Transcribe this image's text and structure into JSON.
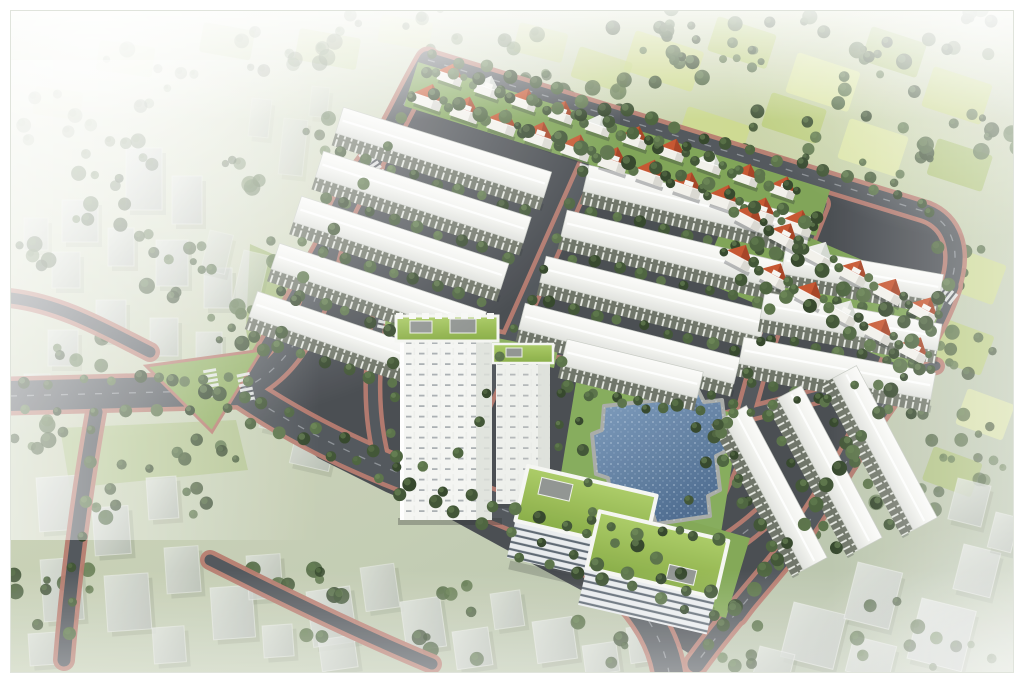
{
  "image": {
    "kind": "aerial-architectural-rendering",
    "subject": "residential-estate-masterplan-birdseye",
    "width": 1024,
    "height": 683,
    "frame_color": "#ffffff"
  },
  "palette": {
    "mist": "#f5f7f3",
    "landLight": "#e2e7d6",
    "land": "#c6cfb4",
    "landDark": "#b7c2aa",
    "asphalt": "#44484d",
    "roadFill": "#4e5358",
    "roadLine": "#b9c0c4",
    "sidewalk": "#b5786b",
    "sidewalkLight": "#c69084",
    "roofWhite": "#f6f7f4",
    "roofShade": "#e0e2dd",
    "facade": "#6b7164",
    "facadeTick": "#eef0ea",
    "villaRed": "#c5522b",
    "villaRedDark": "#9e3c1f",
    "villaWhiteRoof": "#ebede8",
    "villaWall": "#f2f1eb",
    "towerWhite": "#f4f5f2",
    "towerShade": "#dcdfd9",
    "greenRoof": "#96bb4f",
    "greenRoofLight": "#aacb63",
    "poolBlue": "#5d81a8",
    "poolDeep": "#49688c",
    "poolStone": "#a7aaa6",
    "lawn": "#7ca253",
    "lawnBright": "#95b863",
    "ghost": "#c6cbc4",
    "ghostLight": "#dfe3dd",
    "ghostDark": "#b2b8b1"
  },
  "scene": {
    "treeColors": [
      "#3c5130",
      "#48603a",
      "#577045",
      "#2f4226"
    ],
    "treeHighs": [
      "#63804d",
      "#577045",
      "#6f8c58"
    ],
    "fieldColors": [
      "#cdd98b",
      "#b9cc74",
      "#dde7a4",
      "#a6bd68",
      "#c4d480"
    ],
    "site": "426,56 932,210 958,258 944,304 898,372 858,468 800,554 742,618 690,654 618,610 540,568 452,520 386,492 318,458 252,398 286,326 330,244 368,170",
    "contextLawns": [
      {
        "p": "250,244 372,298 384,456 262,420 246,330",
        "f": "#9db66f",
        "o": 0.9
      },
      {
        "p": "60,428 236,420 248,470 70,488",
        "f": "#a4bc74",
        "o": 0.55
      }
    ],
    "rows": {
      "items": [
        [
          342,
          112,
          218
        ],
        [
          322,
          156,
          218
        ],
        [
          300,
          201,
          218
        ],
        [
          278,
          248,
          218
        ],
        [
          256,
          296,
          215
        ],
        [
          588,
          170,
          230
        ],
        [
          566,
          215,
          230
        ],
        [
          545,
          261,
          228
        ],
        [
          524,
          308,
          222
        ],
        [
          566,
          344,
          140
        ],
        [
          785,
          252,
          160
        ],
        [
          764,
          297,
          180
        ],
        [
          743,
          342,
          195
        ]
      ],
      "steep": [
        [
          742,
          408,
          172,
          62
        ],
        [
          797,
          388,
          172,
          62
        ],
        [
          852,
          368,
          172,
          62
        ]
      ]
    },
    "villas": {
      "lines": [
        {
          "from": [
            430,
            92
          ],
          "step": [
            37,
            12.6
          ],
          "rot": 19,
          "size": 30,
          "roofs": "RRRRRRRRRRR"
        },
        {
          "from": [
            452,
            70
          ],
          "step": [
            37,
            12.6
          ],
          "rot": 19,
          "size": 26,
          "roofs": "RWRRWRRWRR"
        },
        {
          "from": [
            752,
            212
          ],
          "step": [
            35,
            18.5
          ],
          "rot": 28,
          "size": 29,
          "roofs": "RRWRRR"
        },
        {
          "from": [
            742,
            252
          ],
          "step": [
            35,
            18.5
          ],
          "rot": 28,
          "size": 29,
          "roofs": "RRRWRR"
        }
      ]
    },
    "roads": {
      "major": [
        {
          "d": "M 10 396 L 240 390",
          "w": 30
        },
        {
          "d": "M 240 390 C 292 368 312 318 324 266 C 332 228 346 194 370 164",
          "w": 22
        },
        {
          "d": "M 370 164 C 392 132 408 94 428 60",
          "w": 18
        },
        {
          "d": "M 428 60 L 926 212",
          "w": 15
        },
        {
          "d": "M 926 212 C 952 222 962 250 950 286",
          "w": 15
        },
        {
          "d": "M 950 286 C 932 338 902 378 874 418 C 846 460 814 520 782 558 C 756 590 722 628 696 664",
          "w": 17
        },
        {
          "d": "M 240 390 C 320 444 400 476 470 498 C 540 520 582 548 620 586 C 648 614 666 644 670 680",
          "w": 28
        },
        {
          "d": "M 618 584 C 678 576 724 552 762 518",
          "w": 16
        }
      ],
      "minor": [
        {
          "d": "M 366 168 C 322 248 284 322 242 388",
          "w": 13
        },
        {
          "d": "M 592 156 L 448 480",
          "w": 13
        },
        {
          "d": "M 820 204 C 790 280 768 330 752 390 C 740 434 722 500 676 556",
          "w": 13
        },
        {
          "d": "M 902 330 C 884 378 858 440 826 492 C 798 538 766 578 738 616",
          "w": 12
        },
        {
          "d": "M 380 316 C 370 368 370 420 384 468",
          "w": 10
        },
        {
          "d": "M 382 314 L 566 352",
          "w": 9
        },
        {
          "d": "M 692 428 L 936 366",
          "w": 9
        },
        {
          "d": "M 96 412 C 84 480 72 560 64 660",
          "w": 13
        },
        {
          "d": "M 10 298 C 62 304 106 330 150 352",
          "w": 11
        },
        {
          "d": "M 210 560 C 290 600 360 634 432 664",
          "w": 11
        }
      ]
    },
    "crosswalks": [
      [
        246,
        388,
        78
      ],
      [
        372,
        164,
        56
      ],
      [
        588,
        160,
        109
      ],
      [
        816,
        212,
        109
      ],
      [
        944,
        292,
        38
      ],
      [
        434,
        484,
        15
      ],
      [
        618,
        580,
        22
      ],
      [
        386,
        316,
        102
      ],
      [
        212,
        384,
        80
      ]
    ],
    "median": {
      "p": "146,366 262,350 212,432",
      "f": "#8fae60"
    },
    "siteLawns": [
      {
        "p": "418,62 830,190 816,236 404,106",
        "f": "#7ca253",
        "o": 1
      },
      {
        "p": "732,204 946,296 916,372 700,280",
        "f": "#7ca253",
        "o": 1
      },
      {
        "p": "576,382 740,414 718,552 554,516",
        "f": "#83aa58",
        "o": 1
      },
      {
        "p": "516,472 750,538 726,618 648,596 600,556 540,510",
        "f": "#7fa652",
        "o": 1
      },
      {
        "p": "386,316 558,350 554,368 384,334",
        "f": "#8aae5c",
        "o": 1
      }
    ],
    "pool": {
      "points": "604,406 660,400 664,392 698,390 704,402 722,400 728,450 716,456 720,490 708,496 710,516 656,524 652,512 614,516 608,478 596,474 592,434 602,430"
    },
    "fields": [
      [
        636,
        30,
        72,
        42,
        18,
        0.9
      ],
      [
        718,
        16,
        62,
        36,
        18,
        0.85
      ],
      [
        798,
        52,
        66,
        42,
        18,
        0.9
      ],
      [
        872,
        26,
        58,
        36,
        18,
        0.85
      ],
      [
        934,
        66,
        62,
        42,
        18,
        0.9
      ],
      [
        688,
        106,
        66,
        40,
        18,
        0.85
      ],
      [
        772,
        92,
        58,
        36,
        18,
        0.8
      ],
      [
        850,
        118,
        62,
        42,
        18,
        0.85
      ],
      [
        938,
        138,
        58,
        38,
        18,
        0.85
      ],
      [
        902,
        208,
        56,
        38,
        20,
        0.8
      ],
      [
        958,
        248,
        52,
        42,
        20,
        0.8
      ],
      [
        944,
        318,
        54,
        42,
        20,
        0.8
      ],
      [
        968,
        388,
        50,
        38,
        20,
        0.75
      ],
      [
        934,
        446,
        52,
        36,
        20,
        0.7
      ],
      [
        580,
        46,
        56,
        32,
        18,
        0.7
      ],
      [
        520,
        22,
        50,
        30,
        14,
        0.5
      ],
      [
        300,
        28,
        62,
        32,
        10,
        0.4
      ],
      [
        382,
        14,
        52,
        28,
        10,
        0.35
      ],
      [
        204,
        22,
        52,
        30,
        10,
        0.3
      ],
      [
        100,
        40,
        56,
        30,
        8,
        0.25
      ],
      [
        36,
        86,
        48,
        28,
        8,
        0.2
      ]
    ],
    "hedges": [
      [
        682,
        58,
        58,
        13,
        0.95
      ],
      [
        780,
        38,
        52,
        11,
        0.9
      ],
      [
        884,
        80,
        62,
        13,
        0.95
      ],
      [
        962,
        38,
        46,
        9,
        0.9
      ],
      [
        760,
        140,
        56,
        11,
        0.9
      ],
      [
        900,
        162,
        52,
        10,
        0.9
      ],
      [
        982,
        142,
        42,
        8,
        0.85
      ],
      [
        940,
        262,
        46,
        9,
        0.85
      ],
      [
        976,
        352,
        42,
        8,
        0.8
      ],
      [
        956,
        432,
        42,
        8,
        0.75
      ],
      [
        638,
        22,
        42,
        8,
        0.85
      ],
      [
        588,
        92,
        44,
        9,
        0.8
      ],
      [
        524,
        60,
        40,
        7,
        0.6
      ],
      [
        440,
        30,
        44,
        7,
        0.5
      ],
      [
        348,
        44,
        52,
        8,
        0.45
      ],
      [
        252,
        56,
        46,
        7,
        0.4
      ],
      [
        150,
        76,
        52,
        8,
        0.35
      ],
      [
        60,
        120,
        44,
        7,
        0.3
      ],
      [
        906,
        506,
        40,
        7,
        0.6
      ],
      [
        986,
        472,
        30,
        5,
        0.6
      ]
    ],
    "scatters": [
      [
        92,
        198,
        48,
        8,
        0.8
      ],
      [
        198,
        296,
        56,
        9,
        0.85
      ],
      [
        322,
        382,
        52,
        9,
        0.9
      ],
      [
        252,
        328,
        40,
        7,
        0.9
      ],
      [
        148,
        498,
        64,
        10,
        0.85
      ],
      [
        58,
        598,
        56,
        9,
        0.8
      ],
      [
        282,
        608,
        64,
        10,
        0.85
      ],
      [
        466,
        622,
        56,
        8,
        0.8
      ],
      [
        610,
        636,
        44,
        6,
        0.8
      ],
      [
        900,
        632,
        52,
        7,
        0.8
      ],
      [
        822,
        524,
        36,
        5,
        0.8
      ],
      [
        40,
        440,
        40,
        7,
        0.8
      ],
      [
        210,
        442,
        36,
        6,
        0.85
      ],
      [
        360,
        300,
        36,
        6,
        0.85
      ],
      [
        300,
        250,
        34,
        6,
        0.8
      ],
      [
        86,
        348,
        38,
        6,
        0.8
      ],
      [
        26,
        260,
        36,
        6,
        0.7
      ],
      [
        170,
        240,
        36,
        6,
        0.8
      ],
      [
        120,
        160,
        40,
        7,
        0.6
      ],
      [
        230,
        170,
        36,
        6,
        0.6
      ],
      [
        330,
        140,
        34,
        6,
        0.6
      ],
      [
        740,
        662,
        40,
        6,
        0.75
      ],
      [
        962,
        662,
        36,
        5,
        0.7
      ]
    ],
    "treelines": [
      [
        436,
        54,
        920,
        202,
        21,
        6
      ],
      [
        432,
        94,
        806,
        220,
        16,
        6.5
      ],
      [
        452,
        72,
        788,
        184,
        14,
        5.5
      ],
      [
        754,
        240,
        928,
        330,
        9,
        6.5
      ],
      [
        742,
        276,
        916,
        366,
        9,
        6
      ],
      [
        940,
        300,
        864,
        434,
        7,
        6.5
      ],
      [
        852,
        452,
        778,
        558,
        7,
        6.5
      ],
      [
        766,
        572,
        706,
        646,
        5,
        6.5
      ],
      [
        586,
        174,
        462,
        452,
        10,
        5
      ],
      [
        814,
        218,
        678,
        528,
        11,
        5.5
      ],
      [
        360,
        180,
        252,
        378,
        9,
        6
      ],
      [
        386,
        146,
        426,
        70,
        4,
        5.5
      ],
      [
        264,
        404,
        424,
        470,
        7,
        6
      ],
      [
        444,
        488,
        636,
        548,
        9,
        6
      ],
      [
        658,
        558,
        760,
        628,
        5,
        6.5
      ],
      [
        252,
        420,
        432,
        498,
        8,
        6
      ],
      [
        452,
        514,
        688,
        592,
        9,
        6
      ],
      [
        20,
        382,
        232,
        378,
        8,
        5.5
      ],
      [
        22,
        412,
        228,
        408,
        7,
        5.5
      ],
      [
        160,
        378,
        244,
        398,
        5,
        6.5
      ],
      [
        90,
        432,
        68,
        636,
        7,
        5.5
      ],
      [
        390,
        330,
        396,
        498,
        6,
        5.5
      ],
      [
        560,
        362,
        560,
        450,
        4,
        5
      ],
      [
        592,
        400,
        732,
        414,
        6,
        5.5
      ],
      [
        588,
        524,
        718,
        542,
        6,
        5.5
      ],
      [
        580,
        424,
        590,
        512,
        4,
        5
      ],
      [
        730,
        426,
        740,
        506,
        4,
        5
      ],
      [
        522,
        556,
        716,
        614,
        8,
        5.5
      ],
      [
        926,
        214,
        948,
        286,
        3,
        5.5
      ],
      [
        694,
        428,
        934,
        368,
        10,
        4.5
      ]
    ],
    "ghosts": [
      [
        126,
        148,
        36,
        62,
        0,
        0.8
      ],
      [
        172,
        176,
        30,
        48,
        0,
        0.8
      ],
      [
        62,
        200,
        36,
        42,
        0,
        0.75
      ],
      [
        108,
        228,
        26,
        38,
        0,
        0.8
      ],
      [
        156,
        240,
        32,
        46,
        0,
        0.8
      ],
      [
        204,
        268,
        28,
        40,
        0,
        0.8
      ],
      [
        52,
        252,
        28,
        36,
        0,
        0.7
      ],
      [
        24,
        218,
        24,
        32,
        0,
        0.6
      ],
      [
        96,
        300,
        30,
        40,
        0,
        0.8
      ],
      [
        150,
        318,
        28,
        38,
        0,
        0.8
      ],
      [
        196,
        332,
        26,
        36,
        0,
        0.75
      ],
      [
        48,
        330,
        30,
        36,
        0,
        0.75
      ],
      [
        24,
        374,
        26,
        30,
        0,
        0.7
      ],
      [
        284,
        118,
        24,
        56,
        6,
        0.45
      ],
      [
        252,
        98,
        20,
        38,
        6,
        0.4
      ],
      [
        312,
        86,
        18,
        30,
        6,
        0.35
      ],
      [
        244,
        250,
        26,
        56,
        13,
        0.6
      ],
      [
        210,
        230,
        24,
        40,
        13,
        0.5
      ],
      [
        282,
        332,
        40,
        62,
        13,
        0.8
      ],
      [
        318,
        352,
        44,
        78,
        13,
        0.75
      ],
      [
        302,
        408,
        40,
        56,
        13,
        0.8
      ],
      [
        268,
        388,
        26,
        40,
        13,
        0.8
      ],
      [
        342,
        300,
        30,
        44,
        13,
        0.7
      ],
      [
        356,
        420,
        30,
        40,
        13,
        0.75
      ],
      [
        36,
        478,
        44,
        54,
        -4,
        0.85
      ],
      [
        92,
        508,
        36,
        48,
        -4,
        0.85
      ],
      [
        146,
        478,
        30,
        42,
        -4,
        0.8
      ],
      [
        40,
        560,
        40,
        62,
        -4,
        0.85
      ],
      [
        104,
        576,
        44,
        56,
        -4,
        0.85
      ],
      [
        164,
        548,
        34,
        46,
        -4,
        0.8
      ],
      [
        210,
        588,
        42,
        52,
        -4,
        0.85
      ],
      [
        28,
        634,
        36,
        32,
        -4,
        0.8
      ],
      [
        152,
        628,
        32,
        36,
        -4,
        0.8
      ],
      [
        246,
        556,
        34,
        44,
        -4,
        0.8
      ],
      [
        262,
        626,
        30,
        32,
        -4,
        0.8
      ],
      [
        306,
        592,
        44,
        56,
        -8,
        0.85
      ],
      [
        360,
        568,
        34,
        44,
        -8,
        0.8
      ],
      [
        318,
        640,
        36,
        32,
        -8,
        0.8
      ],
      [
        400,
        602,
        40,
        50,
        -8,
        0.85
      ],
      [
        452,
        632,
        36,
        38,
        -8,
        0.85
      ],
      [
        490,
        594,
        30,
        36,
        -8,
        0.8
      ],
      [
        532,
        622,
        40,
        42,
        -8,
        0.85
      ],
      [
        582,
        646,
        34,
        30,
        -8,
        0.8
      ],
      [
        626,
        628,
        30,
        36,
        -8,
        0.8
      ],
      [
        794,
        602,
        54,
        56,
        14,
        0.9
      ],
      [
        858,
        562,
        46,
        58,
        14,
        0.9
      ],
      [
        922,
        598,
        56,
        62,
        14,
        0.9
      ],
      [
        964,
        544,
        38,
        46,
        14,
        0.85
      ],
      [
        854,
        636,
        44,
        36,
        14,
        0.85
      ],
      [
        958,
        478,
        34,
        42,
        14,
        0.8
      ],
      [
        996,
        512,
        24,
        36,
        14,
        0.8
      ],
      [
        760,
        646,
        36,
        28,
        14,
        0.8
      ]
    ]
  }
}
